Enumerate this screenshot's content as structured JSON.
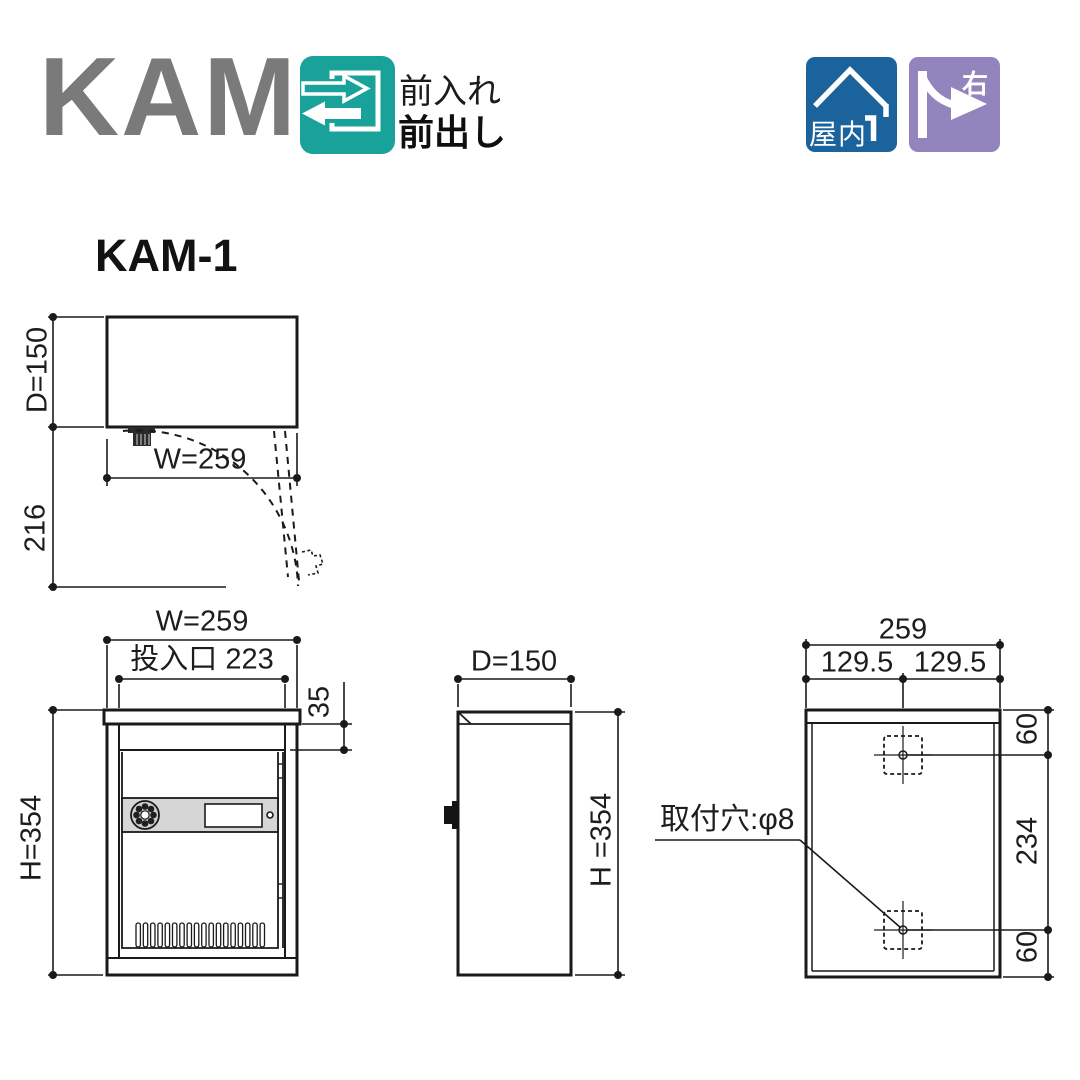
{
  "header": {
    "logo": "KAM",
    "flow_badge": {
      "bg": "#18a29a",
      "line1": "前入れ",
      "line2": "前出し"
    },
    "indoor_badge": {
      "bg": "#1a639c",
      "label": "屋内"
    },
    "right_badge": {
      "bg": "#9284bd",
      "label": "右"
    }
  },
  "model": {
    "title": "KAM-1"
  },
  "dimensions": {
    "top_view": {
      "depth": "D=150",
      "door_clearance": "216",
      "width": "W=259"
    },
    "front_view": {
      "width": "W=259",
      "slot_width": "投入口 223",
      "slot_offset": "35",
      "height": "H=354"
    },
    "side_view": {
      "depth": "D=150",
      "height": "H =354"
    },
    "back_view": {
      "width": "259",
      "half_left": "129.5",
      "half_right": "129.5",
      "top_offset": "60",
      "pitch": "234",
      "bottom_offset": "60",
      "hole_note": "取付穴:φ8"
    }
  }
}
